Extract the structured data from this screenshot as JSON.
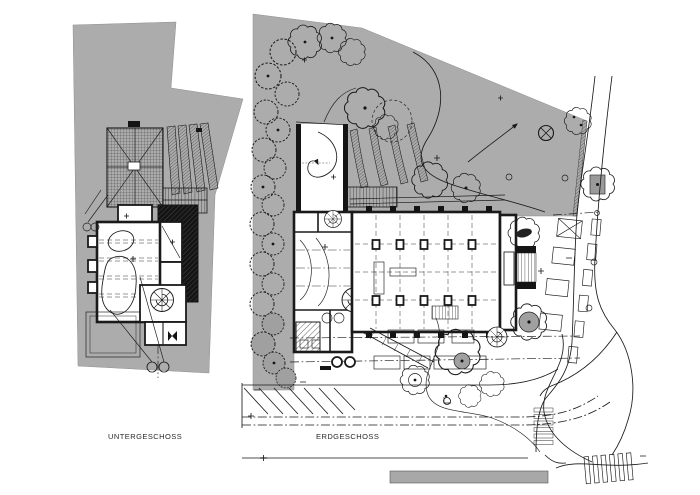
{
  "drawing": {
    "type": "architectural-site-plan",
    "sheet_background": "#ffffff"
  },
  "plans": {
    "untergeschoss": {
      "label": "UNTERGESCHOSS"
    },
    "erdgeschoss": {
      "label": "ERDGESCHOSS"
    }
  },
  "colors": {
    "background": "#ffffff",
    "site_gray": "#acacac",
    "line": "#1a1a1a",
    "poche_black": "#141414",
    "tree_gray": "#a0a0a0",
    "bar_gray": "#a8a8a8"
  },
  "icons": {
    "tree": "scalloped-cloud-circle",
    "shrub": "dashed-zigzag-circle",
    "spiral_stair": "circle-with-radial-treads",
    "survey_point": "crossed-circle",
    "direction_arrow": "curved-arrow",
    "crosswalk": "striped-bars",
    "scale_bar": "gray-rectangle"
  }
}
